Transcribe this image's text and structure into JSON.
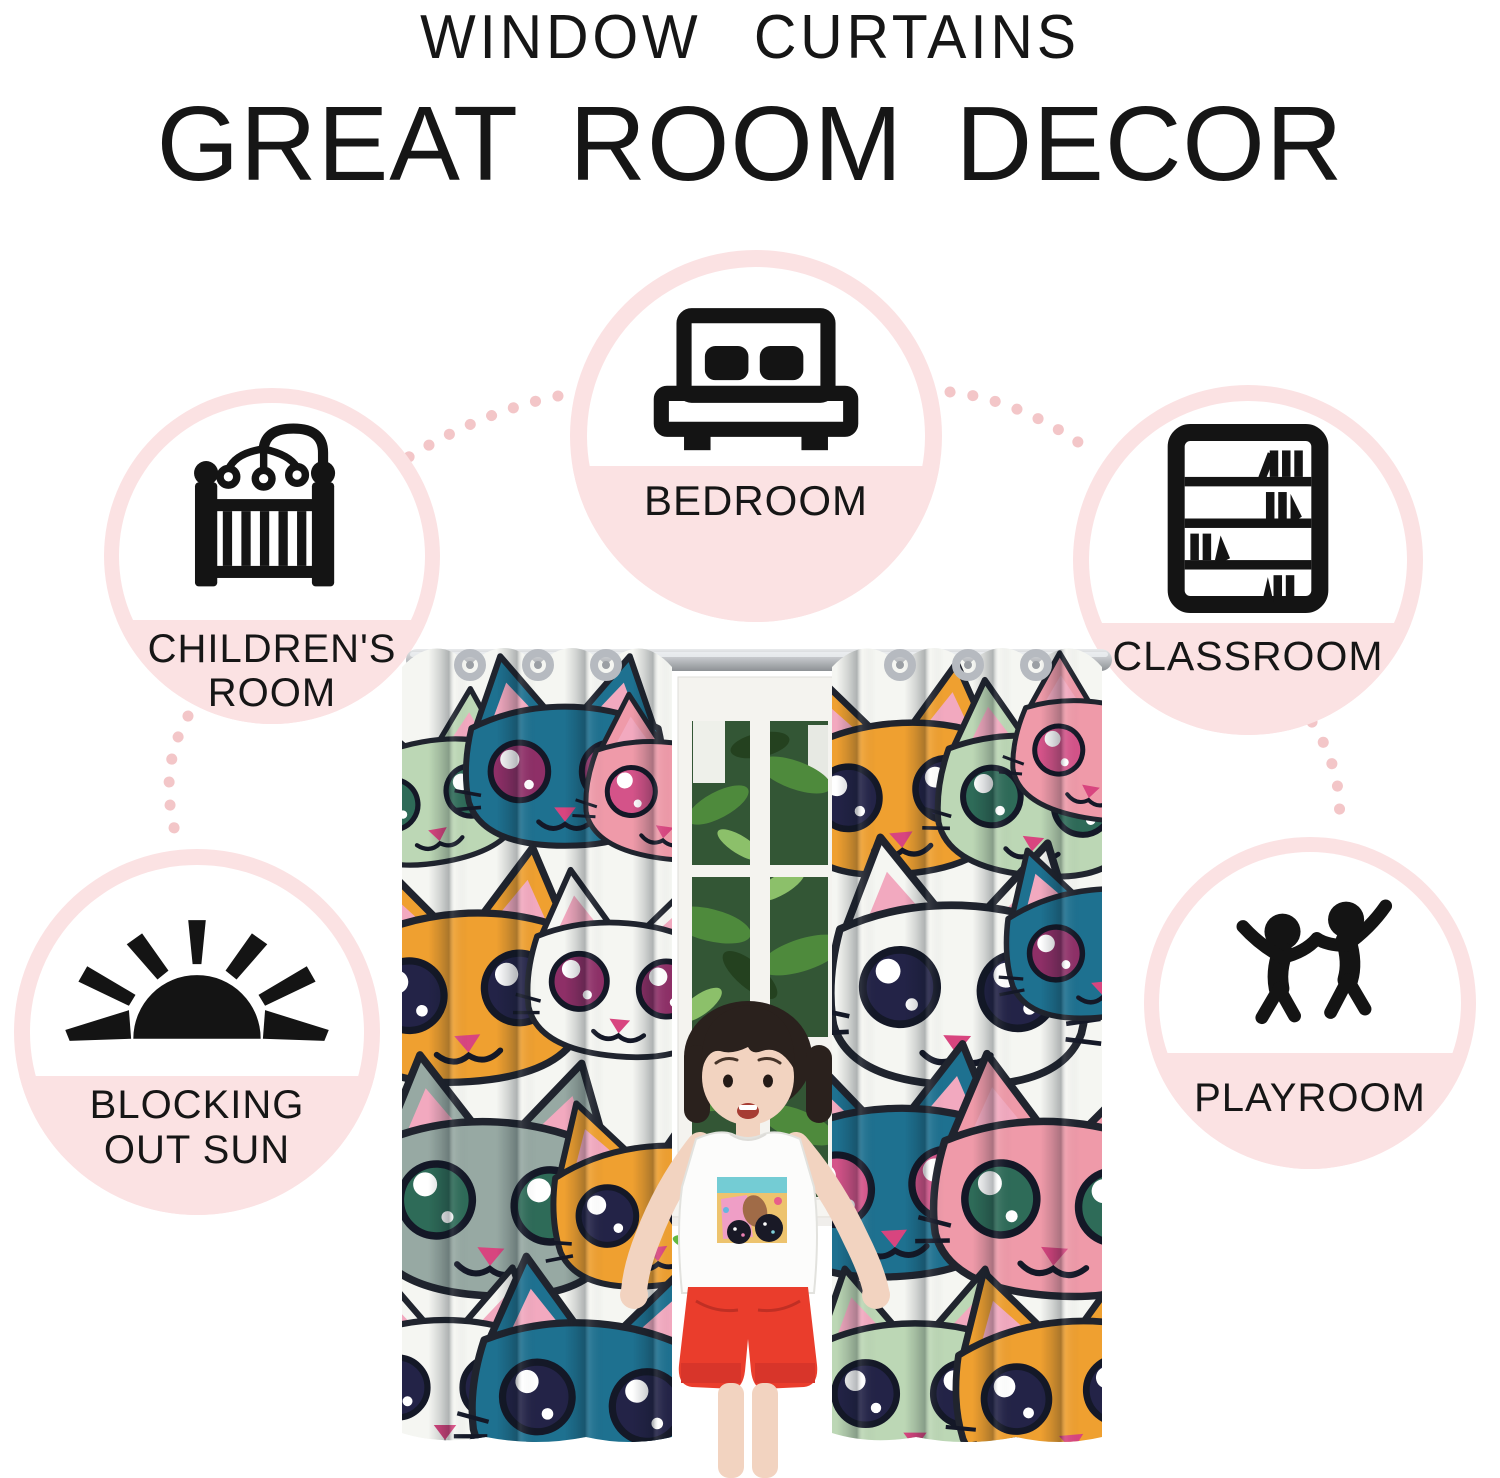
{
  "header": {
    "kicker": "WINDOW CURTAINS",
    "title": "GREAT ROOM DECOR"
  },
  "features": {
    "bedroom": {
      "label": "BEDROOM",
      "icon": "bed-icon"
    },
    "childrens_room": {
      "line1": "CHILDREN'S",
      "line2": "ROOM",
      "icon": "crib-icon"
    },
    "classroom": {
      "label": "CLASSROOM",
      "icon": "bookshelf-icon"
    },
    "blocking_sun": {
      "line1": "BLOCKING",
      "line2": "OUT SUN",
      "icon": "sun-icon"
    },
    "playroom": {
      "label": "PLAYROOM",
      "icon": "children-playing-icon"
    }
  },
  "colors": {
    "circle_pink": "#fbe2e3",
    "dot_pink": "#f3c6c8",
    "text_black": "#161616",
    "icon_black": "#141414",
    "rod_silver": "#c0c3c6",
    "curtain_teal": "#1e7190",
    "curtain_orange": "#efa030",
    "curtain_pink": "#ef9aa9",
    "curtain_sage": "#bcd7b5",
    "curtain_gray": "#97a9a3",
    "curtain_white": "#f5f6f2",
    "iris_navy": "#232347",
    "iris_magenta": "#8e2f67",
    "iris_green": "#2e6b58",
    "iris_pink": "#d45389",
    "ear_pink": "#f2a9bf",
    "nose_pink": "#d8457f",
    "window_green": "#335635",
    "leaf_bright": "#64b840",
    "shorts_red": "#ea3d2c",
    "skin": "#f2d3c0",
    "hair": "#2a211d"
  }
}
